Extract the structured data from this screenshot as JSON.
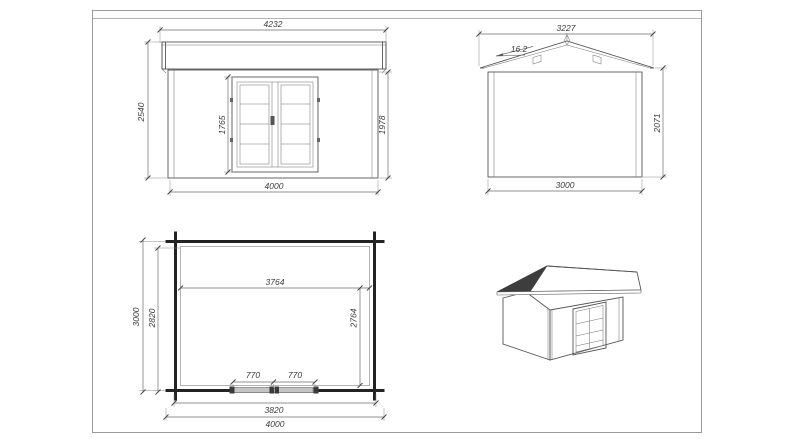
{
  "drawing": {
    "front_elevation": {
      "roof_width": "4232",
      "total_height": "2540",
      "door_height": "1765",
      "wall_height": "1978",
      "wall_width": "4000"
    },
    "side_elevation": {
      "roof_width": "3227",
      "roof_angle": "16.2",
      "wall_height": "2071",
      "wall_width": "3000"
    },
    "floor_plan": {
      "interior_width": "3764",
      "depth_total": "3000",
      "depth_inner": "2820",
      "interior_depth": "2764",
      "door_leaf_left": "770",
      "door_leaf_right": "770",
      "wall_length": "3820",
      "total_width": "4000"
    }
  },
  "colors": {
    "line": "#555555",
    "wall": "#232323",
    "dim_text": "#3c3c3c",
    "frame": "#9a9a9a",
    "roof_shadow": "#3d3d3d",
    "door_leaf_fill": "#c4c4c4"
  }
}
